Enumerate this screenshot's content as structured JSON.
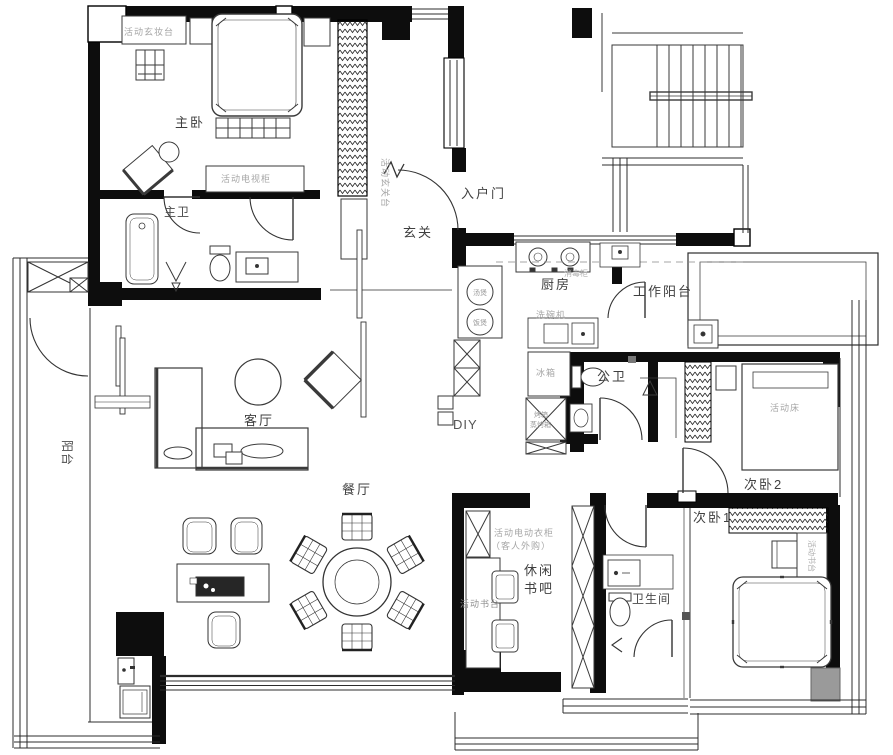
{
  "title": "apartment-floor-plan",
  "rooms": {
    "master_bedroom": "主卧",
    "master_bath": "主卫",
    "entry_door": "入户门",
    "foyer": "玄关",
    "kitchen": "厨房",
    "work_balcony": "工作阳台",
    "public_bath": "公卫",
    "bedroom2": "次卧2",
    "bedroom1": "次卧1",
    "bathroom": "卫生间",
    "living_room": "客厅",
    "dining_room": "餐厅",
    "balcony": "阳台",
    "leisure_bar_line1": "休闲",
    "leisure_bar_line2": "书吧",
    "diy": "DIY"
  },
  "furn": {
    "dressing_table": "活动玄妆台",
    "tv_cabinet": "活动电视柜",
    "entry_console": "活动玄关台",
    "soup_pot": "汤煲",
    "rice_cooker": "饭煲",
    "sterilizer": "消毒柜",
    "dishwasher": "洗碗机",
    "fridge": "冰箱",
    "oven_line1": "烤箱",
    "oven_line2": "蒸烤箱",
    "movable_bed": "活动床",
    "desk_bedroom1": "活动书台",
    "e_wardrobe_line1": "活动电动衣柜",
    "e_wardrobe_line2": "（客人外购）",
    "desk_bar": "活动书台"
  }
}
